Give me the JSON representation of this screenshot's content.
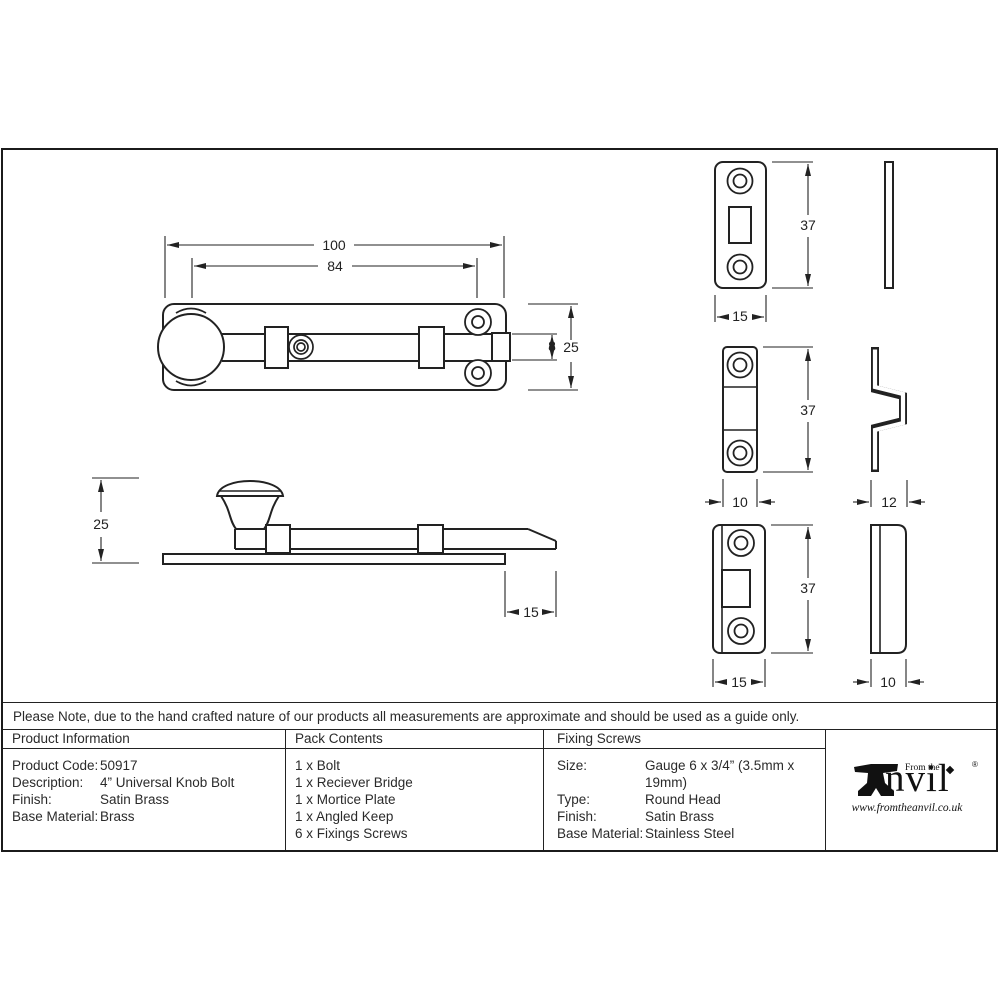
{
  "note": "Please Note, due to the hand crafted nature of our products all measurements are approximate and should be used as a guide only.",
  "table": {
    "product_information": {
      "header": "Product Information",
      "rows": [
        {
          "label": "Product Code:",
          "value": "50917"
        },
        {
          "label": "Description:",
          "value": "4” Universal Knob Bolt"
        },
        {
          "label": "Finish:",
          "value": "Satin Brass"
        },
        {
          "label": "Base Material:",
          "value": "Brass"
        }
      ]
    },
    "pack_contents": {
      "header": "Pack Contents",
      "items": [
        "1 x Bolt",
        "1 x Reciever Bridge",
        "1 x Mortice Plate",
        "1 x Angled Keep",
        "6 x Fixings Screws"
      ]
    },
    "fixing_screws": {
      "header": "Fixing Screws",
      "rows": [
        {
          "label": "Size:",
          "value": "Gauge 6 x 3/4” (3.5mm x 19mm)"
        },
        {
          "label": "Type:",
          "value": "Round Head"
        },
        {
          "label": "Finish:",
          "value": "Satin Brass"
        },
        {
          "label": "Base Material:",
          "value": "Stainless Steel"
        }
      ]
    }
  },
  "logo": {
    "from_the": "From the",
    "name_rest": "nvil",
    "registered": "®",
    "url": "www.fromtheanvil.co.uk"
  },
  "dimensions": {
    "plan": {
      "overall": "100",
      "inner": "84",
      "bolt": "8",
      "plate": "25"
    },
    "side": {
      "height": "25",
      "throw": "15"
    },
    "mortice_plate": {
      "height": "37",
      "width": "15"
    },
    "receiver_bridge": {
      "height": "37",
      "width": "10",
      "depth": "12"
    },
    "angled_keep": {
      "height": "37",
      "width": "15",
      "depth": "10"
    }
  }
}
